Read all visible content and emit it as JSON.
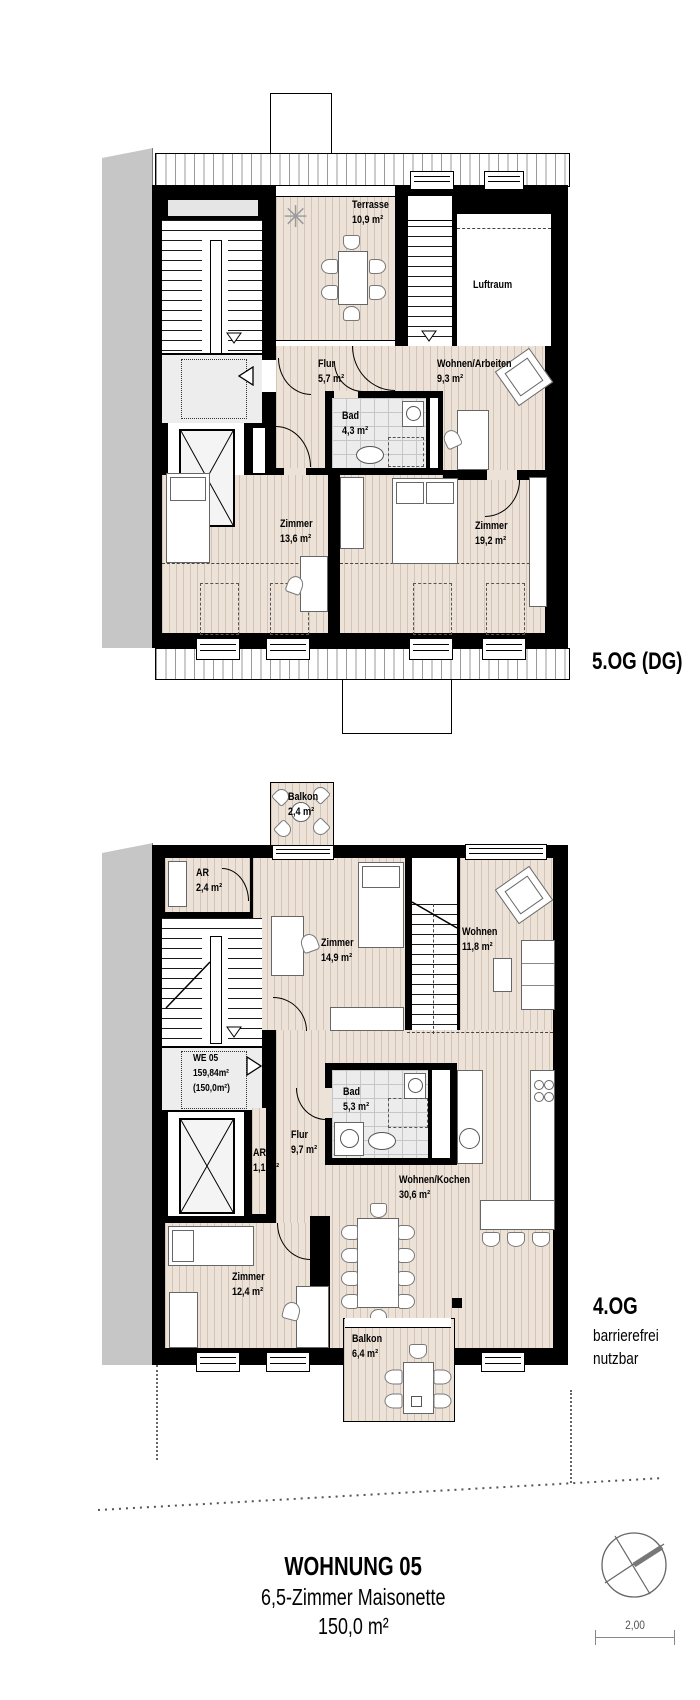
{
  "upper_plan": {
    "floor_label": "5.OG (DG)",
    "rooms": {
      "terrasse": {
        "name": "Terrasse",
        "area": "10,9 m²"
      },
      "luftraum": {
        "name": "Luftraum"
      },
      "flur": {
        "name": "Flur",
        "area": "5,7 m²"
      },
      "wohnen_arbeiten": {
        "name": "Wohnen/Arbeiten",
        "area": "9,3 m²"
      },
      "bad": {
        "name": "Bad",
        "area": "4,3 m²"
      },
      "zimmer_1": {
        "name": "Zimmer",
        "area": "13,6 m²"
      },
      "zimmer_2": {
        "name": "Zimmer",
        "area": "19,2 m²"
      }
    }
  },
  "lower_plan": {
    "floor_label": "4.OG",
    "floor_sublabel_1": "barrierefrei",
    "floor_sublabel_2": "nutzbar",
    "unit_tag": {
      "line1": "WE 05",
      "line2": "159,84m²",
      "line3": "(150,0m²)"
    },
    "rooms": {
      "balkon_top": {
        "name": "Balkon",
        "area": "2,4 m²"
      },
      "ar_1": {
        "name": "AR",
        "area": "2,4 m²"
      },
      "zimmer_3": {
        "name": "Zimmer",
        "area": "14,9 m²"
      },
      "wohnen": {
        "name": "Wohnen",
        "area": "11,8 m²"
      },
      "bad_2": {
        "name": "Bad",
        "area": "5,3 m²"
      },
      "flur_2": {
        "name": "Flur",
        "area": "9,7 m²"
      },
      "ar_2": {
        "name": "AR",
        "area": "1,1 m²"
      },
      "wohnen_kochen": {
        "name": "Wohnen/Kochen",
        "area": "30,6 m²"
      },
      "zimmer_4": {
        "name": "Zimmer",
        "area": "12,4 m²"
      },
      "balkon_bottom": {
        "name": "Balkon",
        "area": "6,4 m²"
      }
    }
  },
  "footer": {
    "title": "WOHNUNG 05",
    "subtitle": "6,5-Zimmer Maisonette",
    "area": "150,0 m²",
    "scale_label": "2,00"
  },
  "icons": {
    "plant_glyph": "✳"
  },
  "colors": {
    "wall": "#000000",
    "floor_hatch": "#ece2d8",
    "tiles": "#ececec",
    "neighbor_building": "#c6c6c6",
    "landing": "#ededed",
    "line_gray": "#777777"
  }
}
